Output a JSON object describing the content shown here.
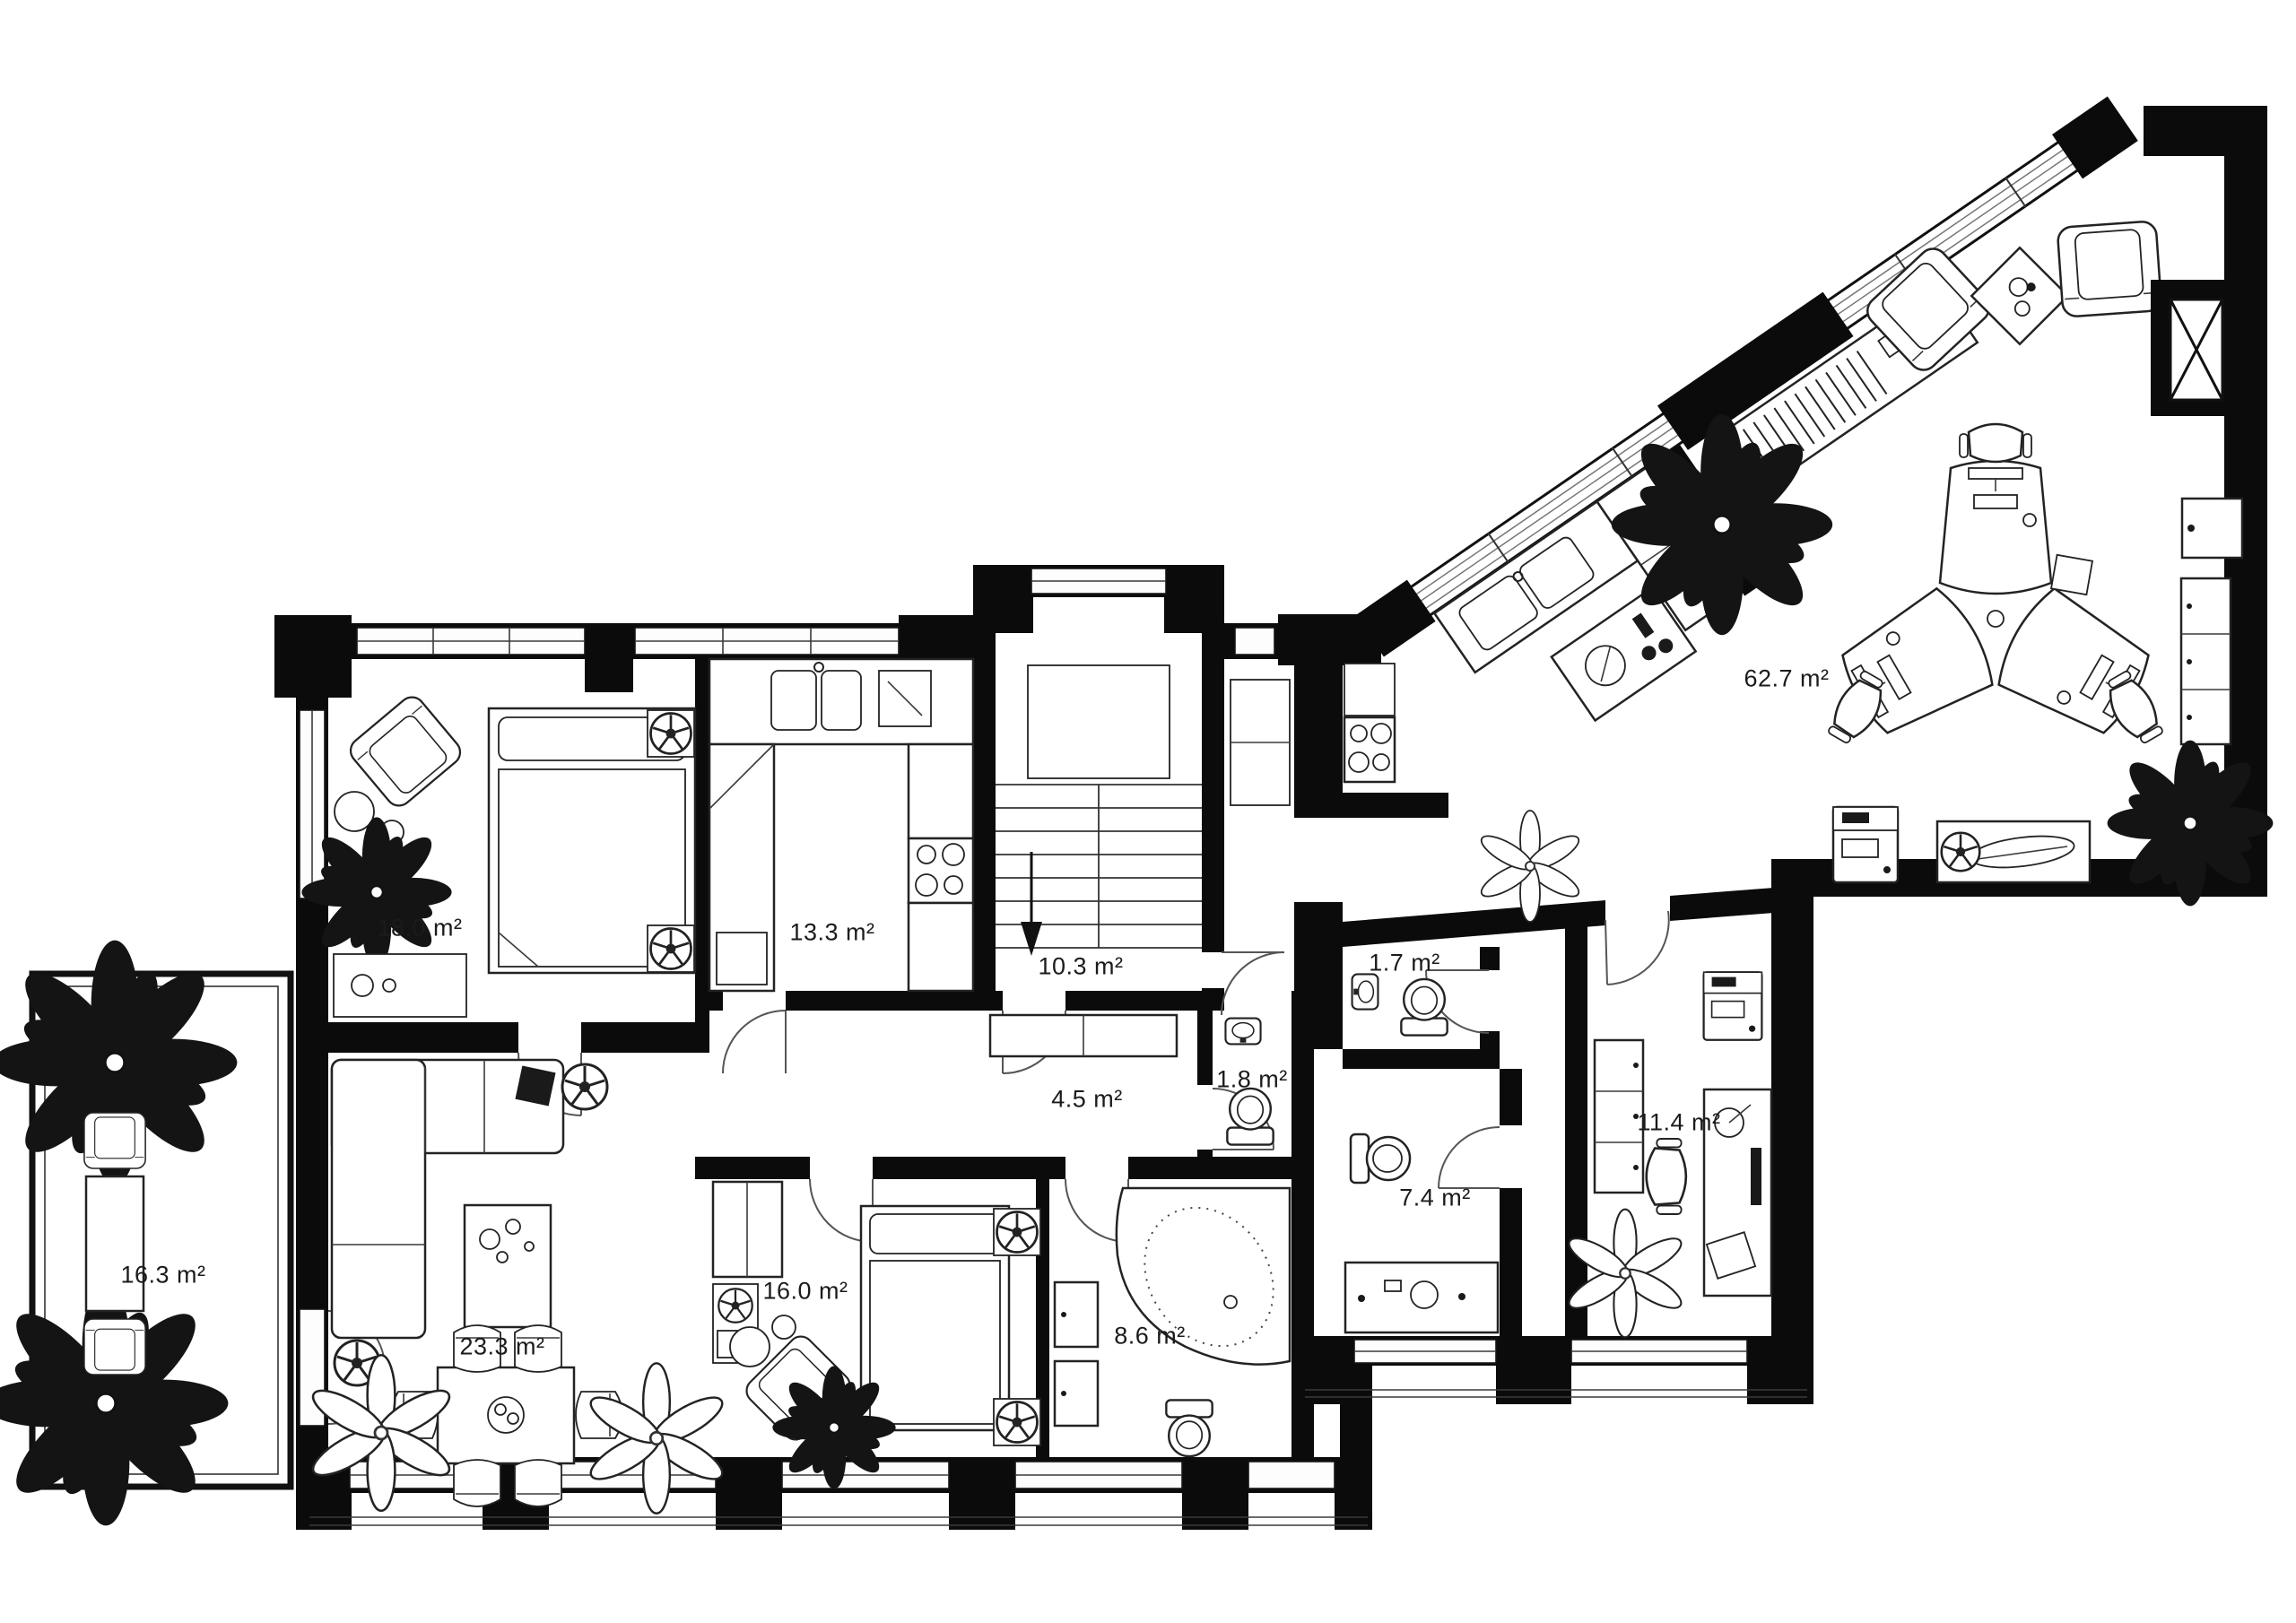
{
  "plan": {
    "unit": "m²",
    "colors": {
      "wall": "#0b0b0b",
      "background": "#ffffff",
      "furniture_line": "#232323",
      "label_text": "#1b1b1b"
    },
    "rooms": [
      {
        "id": "bedroom-main",
        "type": "bedroom",
        "area_label": "18.0 m²"
      },
      {
        "id": "kitchen",
        "type": "kitchen",
        "area_label": "13.3 m²"
      },
      {
        "id": "stair-hall",
        "type": "staircase hall",
        "area_label": "10.3 m²"
      },
      {
        "id": "corridor",
        "type": "corridor",
        "area_label": "4.5 m²"
      },
      {
        "id": "wc",
        "type": "wc",
        "area_label": "1.8 m²"
      },
      {
        "id": "guest-wc",
        "type": "wc",
        "area_label": "1.7 m²"
      },
      {
        "id": "open-office",
        "type": "open space office",
        "area_label": "62.7 m²"
      },
      {
        "id": "bathroom-right",
        "type": "bathroom",
        "area_label": "7.4 m²"
      },
      {
        "id": "office-room",
        "type": "office room",
        "area_label": "11.4 m²"
      },
      {
        "id": "terrace",
        "type": "terrace",
        "area_label": "16.3 m²"
      },
      {
        "id": "living-room",
        "type": "living room",
        "area_label": "23.3 m²"
      },
      {
        "id": "bedroom-second",
        "type": "bedroom",
        "area_label": "16.0 m²"
      },
      {
        "id": "bathroom-main",
        "type": "bathroom",
        "area_label": "8.6 m²"
      }
    ]
  }
}
